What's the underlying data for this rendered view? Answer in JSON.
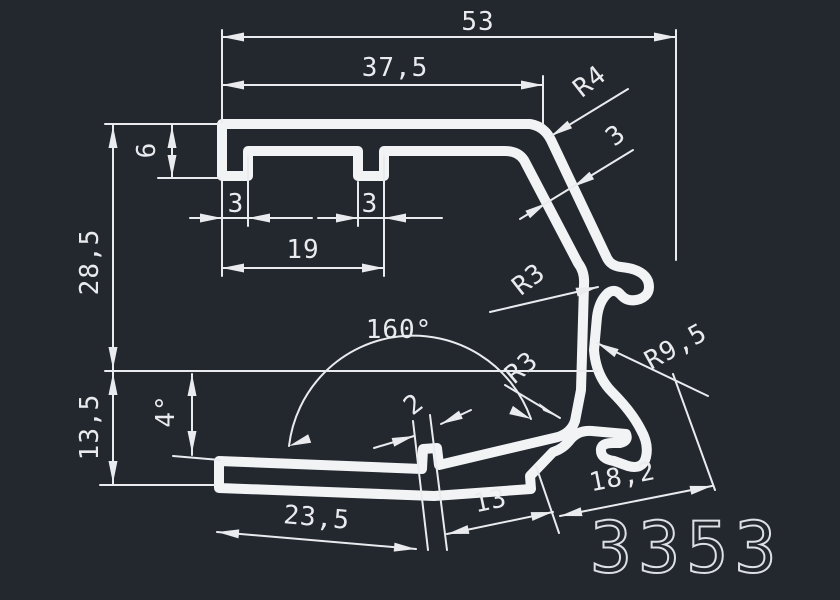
{
  "drawing": {
    "title": "extrusion-profile-drawing",
    "part_number": "3353",
    "colors": {
      "background": "#23272e",
      "lines": "#eef0f2",
      "text": "#e9ebee"
    },
    "labels": {
      "width_total": "53",
      "width_top": "37,5",
      "lip_height": "6",
      "height_upper": "28,5",
      "height_lower": "13,5",
      "angle_small": "4°",
      "angle_big": "160°",
      "slot_span": "19",
      "lip_width_left": "3",
      "lip_width_right": "3",
      "radius_r4": "R4",
      "wall_thickness": "3",
      "radius_r3_upper": "R3",
      "radius_r3_lower": "R3",
      "radius_r9_5": "R9,5",
      "tab_width": "2",
      "arm_left_len": "23,5",
      "arm_mid_len": "13",
      "arm_right_len": "18,2"
    }
  }
}
